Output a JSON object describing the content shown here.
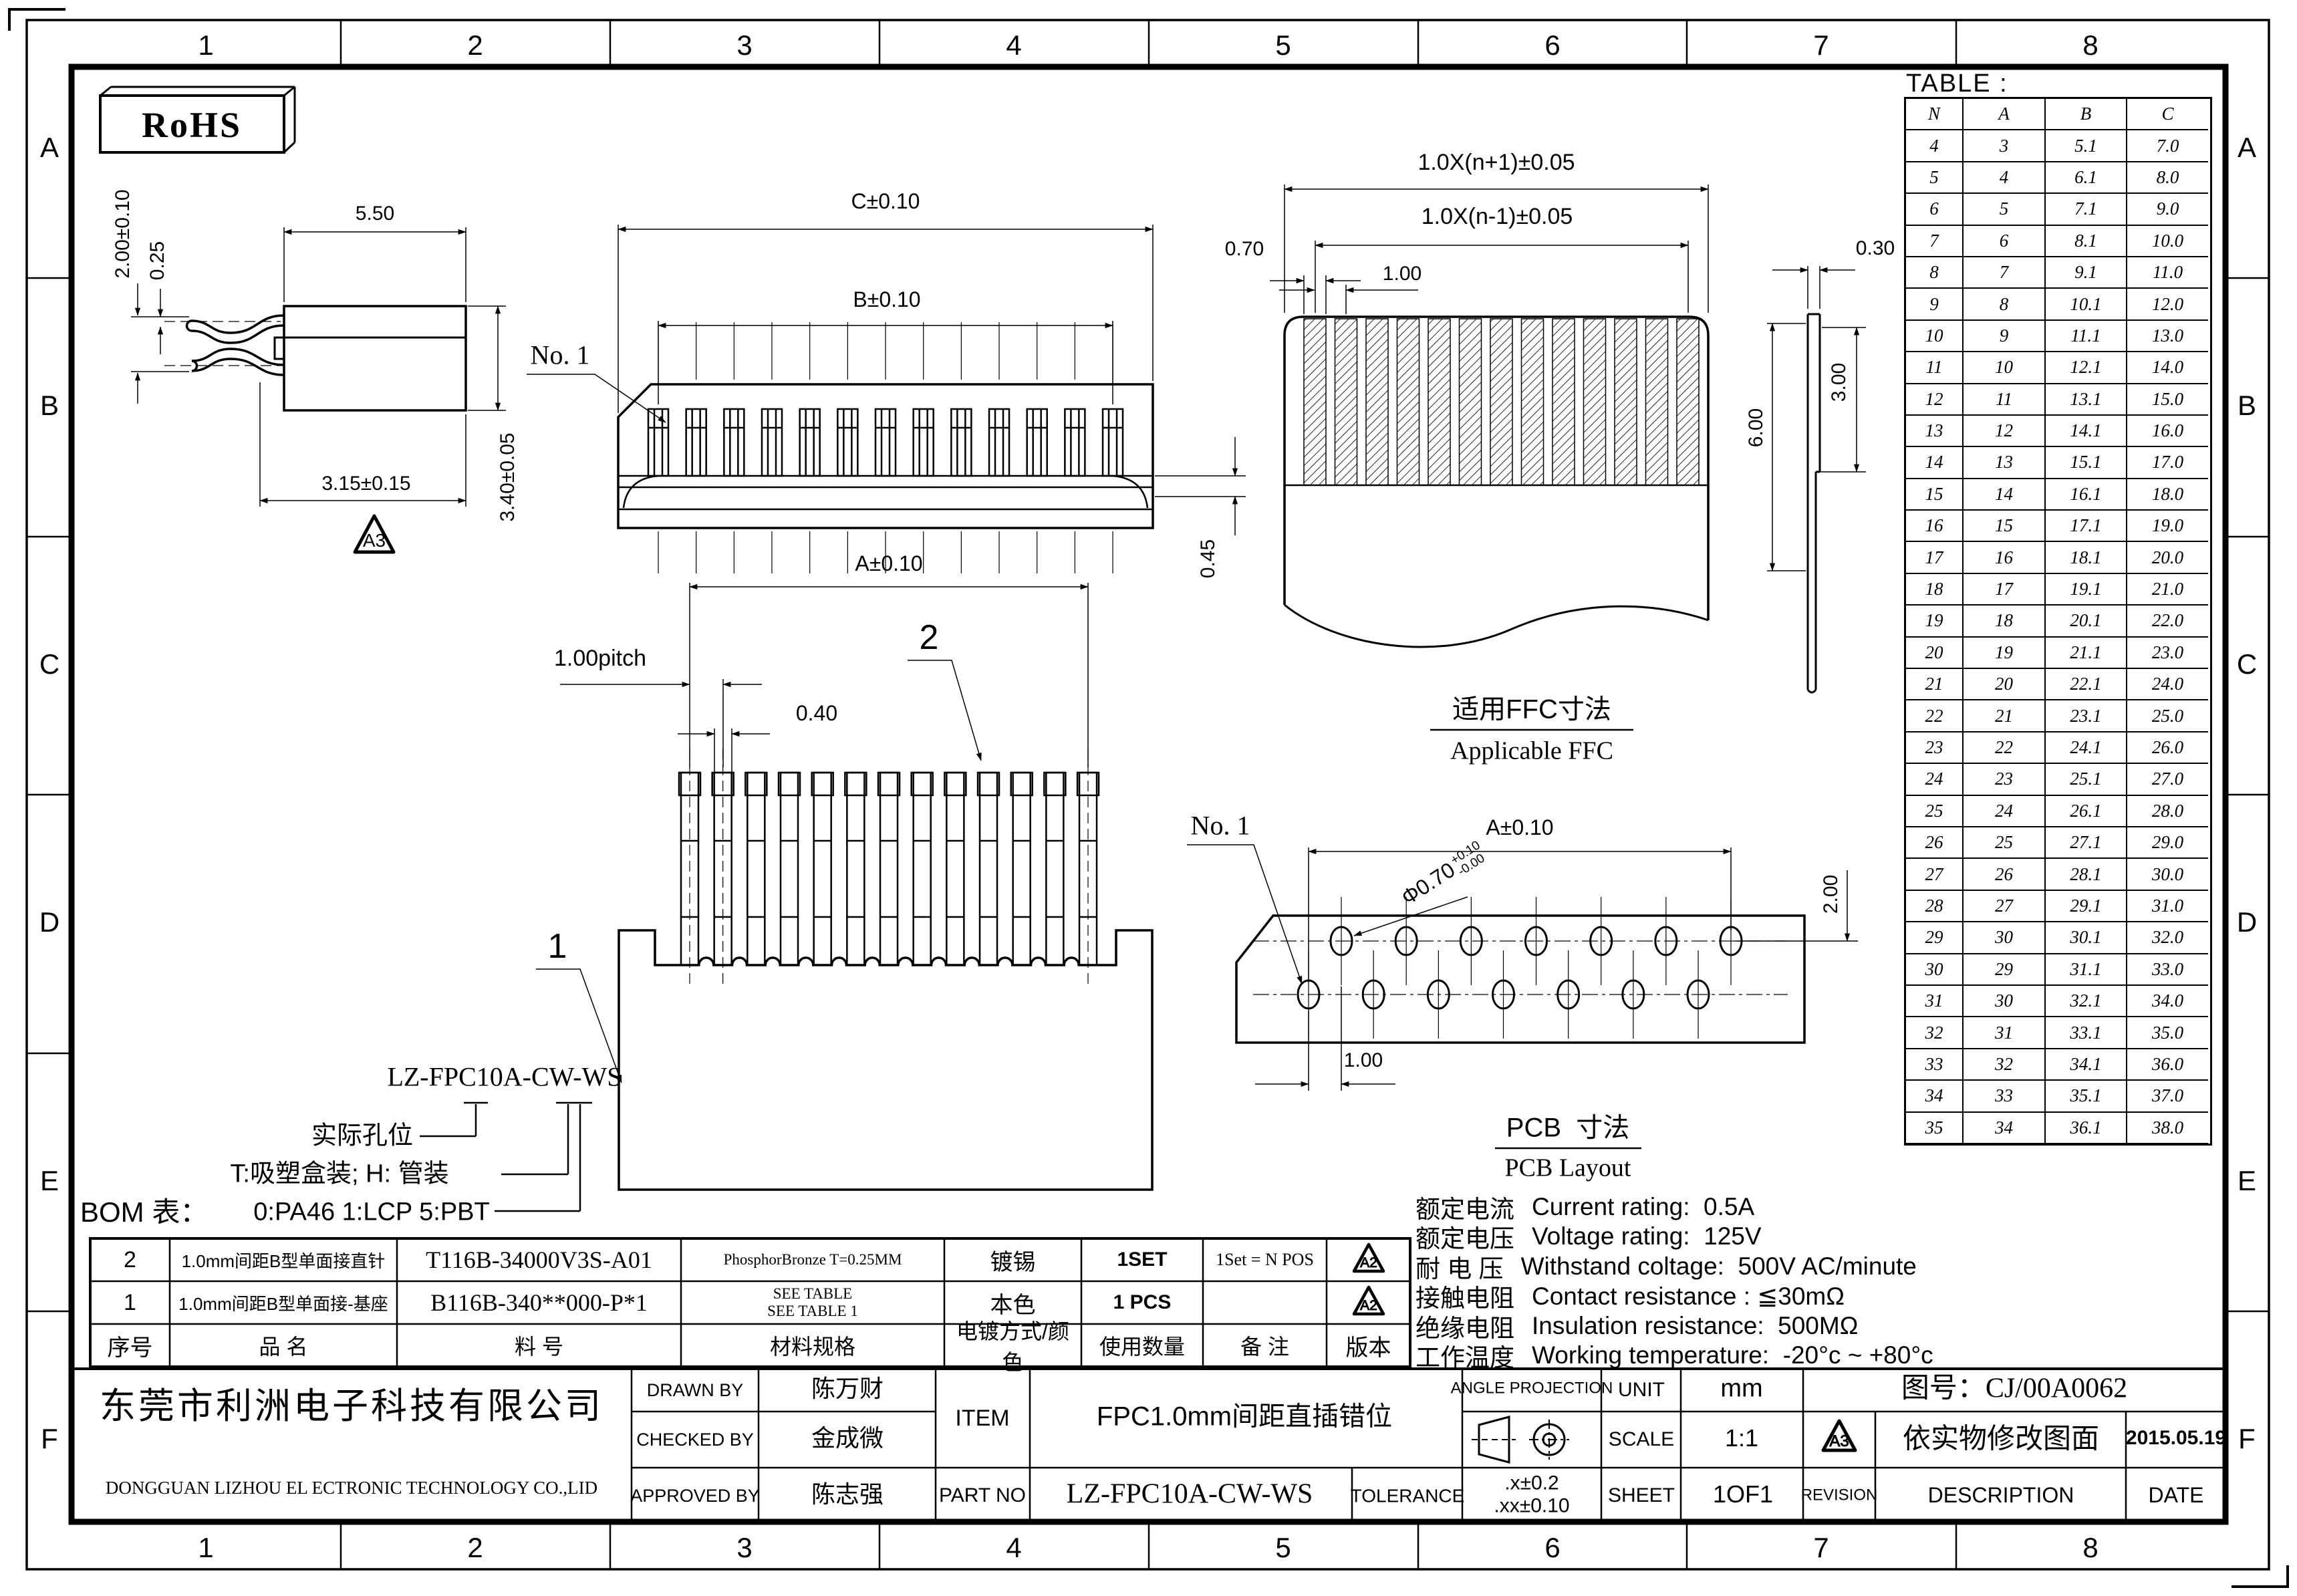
{
  "zones": {
    "cols": [
      "1",
      "2",
      "3",
      "4",
      "5",
      "6",
      "7",
      "8"
    ],
    "rows": [
      "A",
      "B",
      "C",
      "D",
      "E",
      "F"
    ]
  },
  "rohs": "RoHS",
  "size_table": {
    "title": "TABLE :",
    "headers": [
      "N",
      "A",
      "B",
      "C"
    ],
    "rows": [
      [
        "4",
        "3",
        "5.1",
        "7.0"
      ],
      [
        "5",
        "4",
        "6.1",
        "8.0"
      ],
      [
        "6",
        "5",
        "7.1",
        "9.0"
      ],
      [
        "7",
        "6",
        "8.1",
        "10.0"
      ],
      [
        "8",
        "7",
        "9.1",
        "11.0"
      ],
      [
        "9",
        "8",
        "10.1",
        "12.0"
      ],
      [
        "10",
        "9",
        "11.1",
        "13.0"
      ],
      [
        "11",
        "10",
        "12.1",
        "14.0"
      ],
      [
        "12",
        "11",
        "13.1",
        "15.0"
      ],
      [
        "13",
        "12",
        "14.1",
        "16.0"
      ],
      [
        "14",
        "13",
        "15.1",
        "17.0"
      ],
      [
        "15",
        "14",
        "16.1",
        "18.0"
      ],
      [
        "16",
        "15",
        "17.1",
        "19.0"
      ],
      [
        "17",
        "16",
        "18.1",
        "20.0"
      ],
      [
        "18",
        "17",
        "19.1",
        "21.0"
      ],
      [
        "19",
        "18",
        "20.1",
        "22.0"
      ],
      [
        "20",
        "19",
        "21.1",
        "23.0"
      ],
      [
        "21",
        "20",
        "22.1",
        "24.0"
      ],
      [
        "22",
        "21",
        "23.1",
        "25.0"
      ],
      [
        "23",
        "22",
        "24.1",
        "26.0"
      ],
      [
        "24",
        "23",
        "25.1",
        "27.0"
      ],
      [
        "25",
        "24",
        "26.1",
        "28.0"
      ],
      [
        "26",
        "25",
        "27.1",
        "29.0"
      ],
      [
        "27",
        "26",
        "28.1",
        "30.0"
      ],
      [
        "28",
        "27",
        "29.1",
        "31.0"
      ],
      [
        "29",
        "30",
        "30.1",
        "32.0"
      ],
      [
        "30",
        "29",
        "31.1",
        "33.0"
      ],
      [
        "31",
        "30",
        "32.1",
        "34.0"
      ],
      [
        "32",
        "31",
        "33.1",
        "35.0"
      ],
      [
        "33",
        "32",
        "34.1",
        "36.0"
      ],
      [
        "34",
        "33",
        "35.1",
        "37.0"
      ],
      [
        "35",
        "34",
        "36.1",
        "38.0"
      ]
    ]
  },
  "dims": {
    "side_width": "5.50",
    "side_pin_off": "2.00±0.10",
    "side_pin_t": "0.25",
    "side_depth": "3.15±0.15",
    "side_height": "3.40±0.05",
    "side_badge": "A3",
    "front_c": "C±0.10",
    "front_b": "B±0.10",
    "front_no1": "No. 1",
    "front_gap": "0.45",
    "ffc_outer": "1.0X(n+1)±0.05",
    "ffc_inner": "1.0X(n-1)±0.05",
    "ffc_w": "0.70",
    "ffc_p": "1.00",
    "ffc_cap_cn": "适用FFC寸法",
    "ffc_cap_en": "Applicable FFC",
    "ffc_t": "0.30",
    "ffc_len": "6.00",
    "ffc_exp": "3.00",
    "pins_a": "A±0.10",
    "pins_pitch": "1.00pitch",
    "pins_w": "0.40",
    "balloon1": "1",
    "balloon2": "2",
    "pcb_a": "A±0.10",
    "pcb_no1": "No. 1",
    "pcb_hole": "Φ0.70",
    "pcb_hole_up": "+0.10",
    "pcb_hole_dn": "-0.00",
    "pcb_row": "2.00",
    "pcb_pitch": "1.00",
    "pcb_cap_cn": "PCB  寸法",
    "pcb_cap_en": "PCB Layout"
  },
  "part_tree": {
    "pn": "LZ-FPC10A-CW-WS",
    "l1": "实际孔位",
    "l2": "T:吸塑盒装; H: 管装",
    "l3": "0:PA46 1:LCP 5:PBT"
  },
  "bom": {
    "label": "BOM 表：",
    "headers": [
      "序号",
      "品        名",
      "料        号",
      "材料规格",
      "电镀方式/颜色",
      "使用数量",
      "备    注",
      "版本"
    ],
    "rows": [
      [
        "2",
        "1.0mm间距B型单面接直针",
        "T116B-34000V3S-A01",
        "PhosphorBronze T=0.25MM",
        "镀锡",
        "1SET",
        "1Set = N POS",
        "A2"
      ],
      [
        "1",
        "1.0mm间距B型单面接-基座",
        "B116B-340**000-P*1",
        "SEE TABLE\nSEE TABLE 1",
        "本色",
        "1 PCS",
        "",
        "A2"
      ]
    ]
  },
  "ratings": [
    {
      "cn": "额定电流",
      "en": "Current rating:  0.5A"
    },
    {
      "cn": "额定电压",
      "en": "Voltage rating:  125V"
    },
    {
      "cn": "耐 电 压",
      "en": "Withstand coltage:  500V AC/minute"
    },
    {
      "cn": "接触电阻",
      "en": "Contact resistance : ≦30mΩ"
    },
    {
      "cn": "绝缘电阻",
      "en": "Insulation resistance:  500MΩ"
    },
    {
      "cn": "工作温度",
      "en": "Working temperature:  -20°c ~ +80°c"
    }
  ],
  "title_block": {
    "company_cn": "东莞市利洲电子科技有限公司",
    "company_en": "DONGGUAN LIZHOU EL ECTRONIC TECHNOLOGY CO.,LID",
    "drawn_label": "DRAWN BY",
    "drawn": "陈万财",
    "checked_label": "CHECKED BY",
    "checked": "金成微",
    "approved_label": "APPROVED BY",
    "approved": "陈志强",
    "item_label": "ITEM",
    "item": "FPC1.0mm间距直插错位",
    "partno_label": "PART NO",
    "partno": "LZ-FPC10A-CW-WS",
    "tolerance_label": "TOLERANCE",
    "tol1": ".x±0.2",
    "tol2": ".xx±0.10",
    "angle_label": "ANGLE PROJECTION",
    "unit_label": "UNIT",
    "unit": "mm",
    "scale_label": "SCALE",
    "scale": "1:1",
    "sheet_label": "SHEET",
    "sheet": "1OF1",
    "drawing_no": "图号：CJ/00A0062",
    "rev_mark": "A3",
    "rev_desc": "依实物修改图面",
    "rev_date": "2015.05.19",
    "revision_label": "REVISION",
    "description_label": "DESCRIPTION",
    "date_label": "DATE"
  }
}
